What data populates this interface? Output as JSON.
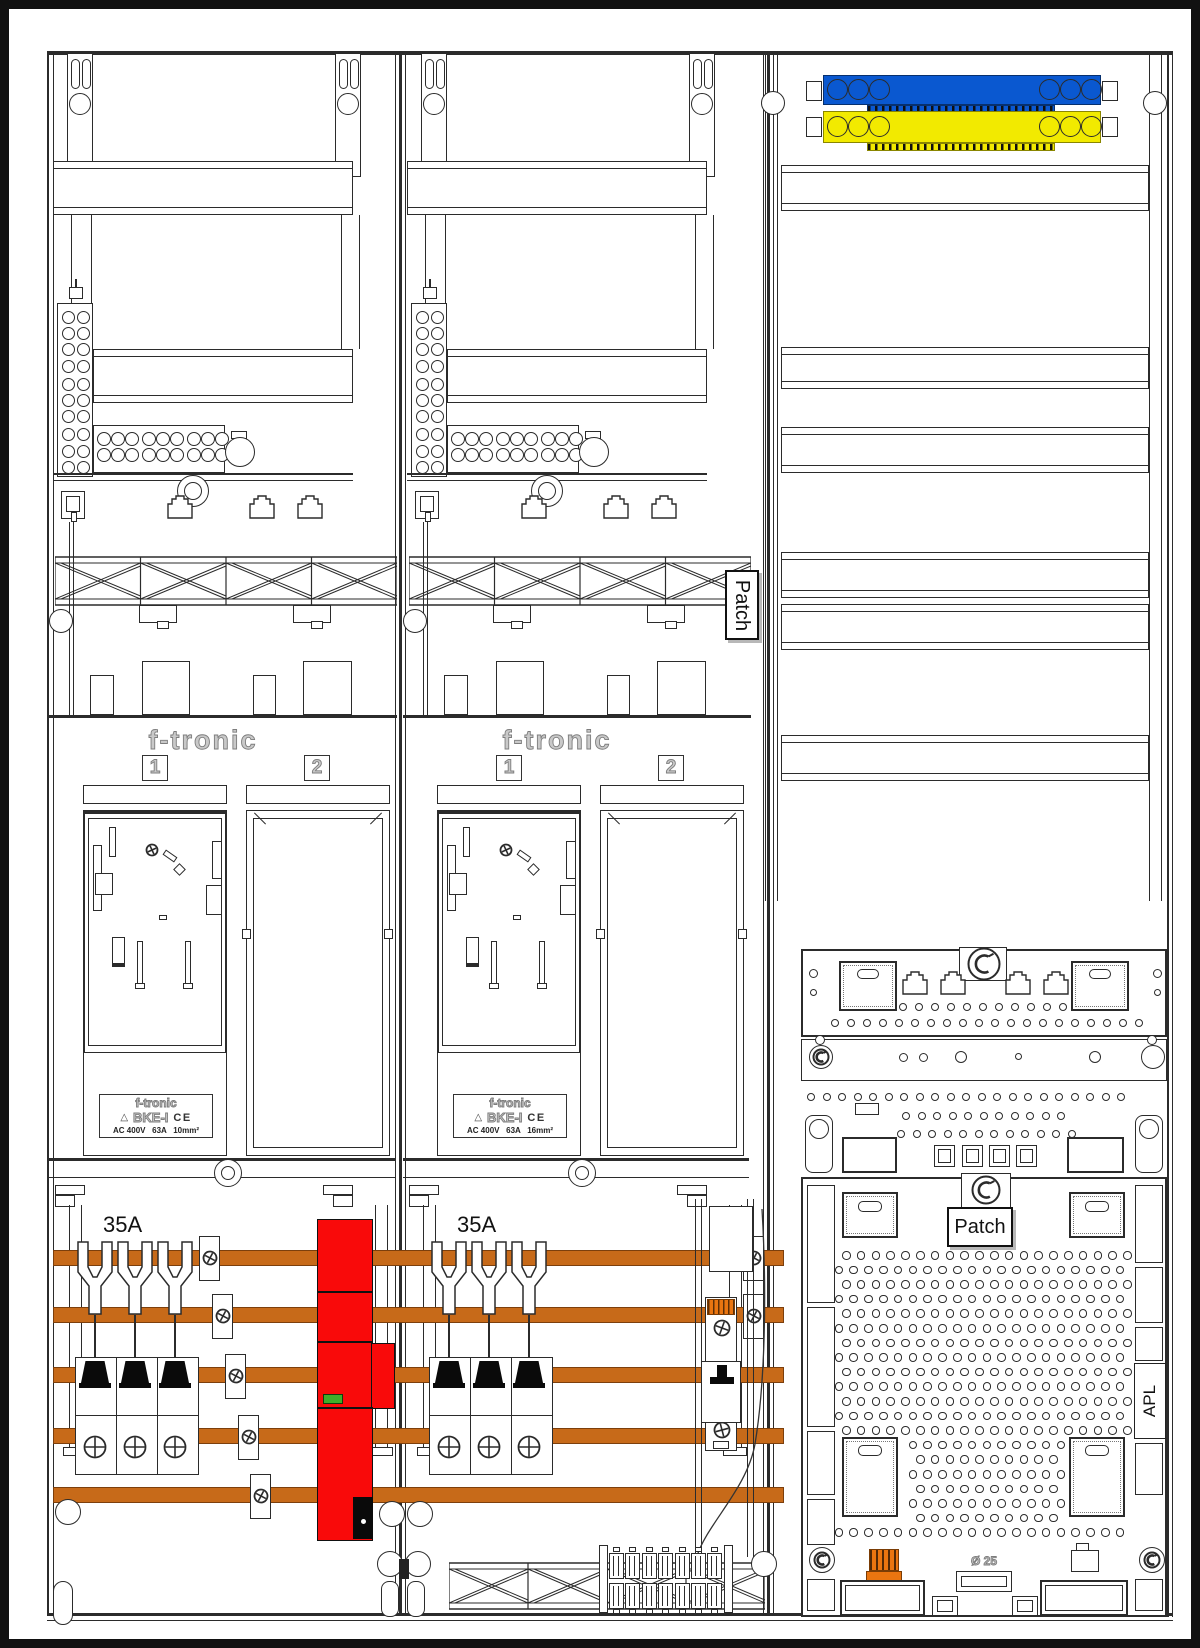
{
  "colors": {
    "neutral_busbar": "#0a58d0",
    "pe_busbar": "#f2ea00",
    "phase_busbar": "#c76a19",
    "connector": "#ea7510",
    "sls_switch": "#f90a0a",
    "indicator": "#3fae2a"
  },
  "meter_fields": [
    {
      "brand": "f-tronic",
      "slot_labels": [
        "1",
        "2"
      ],
      "type_plate": {
        "brand": "f-tronic",
        "mark": "△",
        "model": "BKE-I",
        "ce": "CE",
        "rating": "AC 400V   63A   10mm²"
      },
      "breaker_rating": "35A"
    },
    {
      "brand": "f-tronic",
      "slot_labels": [
        "1",
        "2"
      ],
      "type_plate": {
        "brand": "f-tronic",
        "mark": "△",
        "model": "BKE-I",
        "ce": "CE",
        "rating": "AC 400V   63A   16mm²"
      },
      "breaker_rating": "35A"
    }
  ],
  "right_field": {
    "duct_label": "Patch",
    "panel_label": "Patch",
    "apl_label": "APL",
    "grommet_label": "Ø 25"
  }
}
